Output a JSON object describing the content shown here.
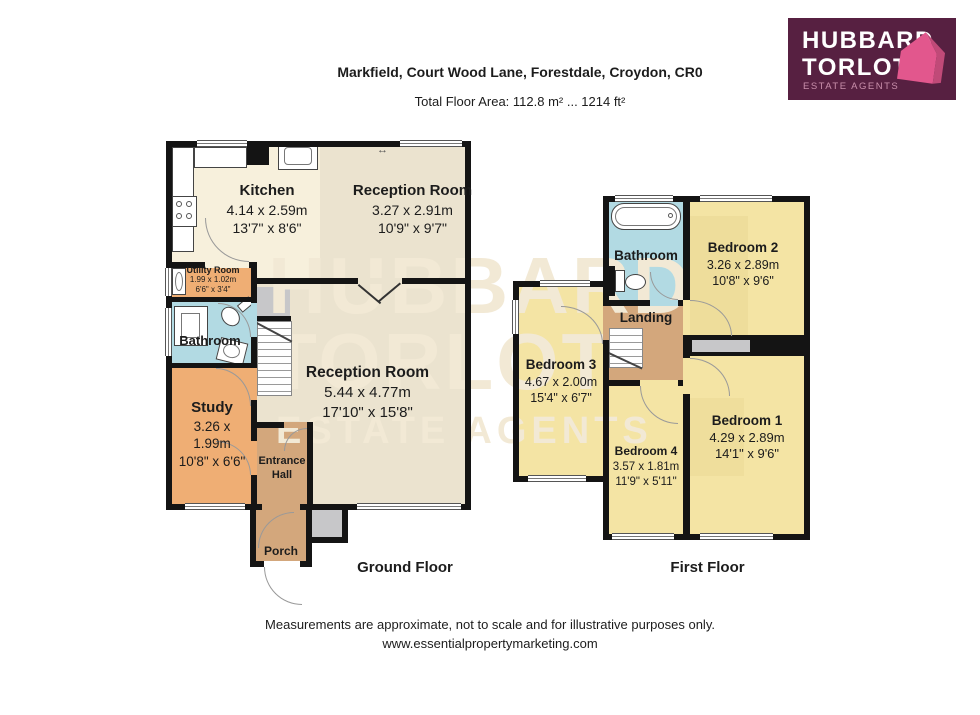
{
  "header": {
    "title": "Markfield, Court Wood Lane, Forestdale, Croydon, CR0",
    "subtitle": "Total Floor Area: 112.8 m² ... 1214 ft²"
  },
  "logo": {
    "line1": "HUBBARD",
    "line2": "TORLOT",
    "tagline": "ESTATE AGENTS"
  },
  "watermark": {
    "line1": "HUBBARD",
    "line2": "TORLOT",
    "line3": "ESTATE AGENTS"
  },
  "ground_floor": {
    "label": "Ground Floor",
    "rooms": [
      {
        "name": "Kitchen",
        "metric": "4.14 x 2.59m",
        "imperial": "13'7\" x 8'6\""
      },
      {
        "name": "Reception Room",
        "metric": "3.27 x 2.91m",
        "imperial": "10'9\" x 9'7\""
      },
      {
        "name": "Utility Room",
        "metric": "1.99 x 1.02m",
        "imperial": "6'6\" x 3'4\""
      },
      {
        "name": "Bathroom"
      },
      {
        "name": "Study",
        "metric": "3.26 x 1.99m",
        "imperial": "10'8\" x 6'6\""
      },
      {
        "name": "Reception Room",
        "metric": "5.44 x 4.77m",
        "imperial": "17'10\" x 15'8\""
      },
      {
        "name": "Entrance Hall"
      },
      {
        "name": "Porch"
      }
    ]
  },
  "first_floor": {
    "label": "First Floor",
    "rooms": [
      {
        "name": "Bathroom"
      },
      {
        "name": "Bedroom 2",
        "metric": "3.26 x 2.89m",
        "imperial": "10'8\" x 9'6\""
      },
      {
        "name": "Landing"
      },
      {
        "name": "Bedroom 3",
        "metric": "4.67 x 2.00m",
        "imperial": "15'4\" x 6'7\""
      },
      {
        "name": "Bedroom 1",
        "metric": "4.29 x 2.89m",
        "imperial": "14'1\" x 9'6\""
      },
      {
        "name": "Bedroom 4",
        "metric": "3.57 x 1.81m",
        "imperial": "11'9\" x 5'11\""
      }
    ]
  },
  "icons": {
    "window_arrow": "↔"
  },
  "footer": {
    "line1": "Measurements are approximate, not to scale and for illustrative purposes only.",
    "line2": "www.essentialpropertymarketing.com"
  },
  "colors": {
    "wall": "#141414",
    "cream": "#F7F0DC",
    "beige": "#EBE3CF",
    "orange": "#EFAE74",
    "tan": "#D3A77C",
    "blue": "#B2DAE3",
    "yellow": "#F4E4A4",
    "yellow_dark": "#EAD793",
    "gray": "#C7C7C9",
    "watermark": "#F2E9D5",
    "logo_bg": "#572041",
    "logo_pink": "#E2578D",
    "logo_pink_dark": "#C04A78",
    "logo_tagline": "#C98FAB",
    "text": "#1C1C1C"
  }
}
